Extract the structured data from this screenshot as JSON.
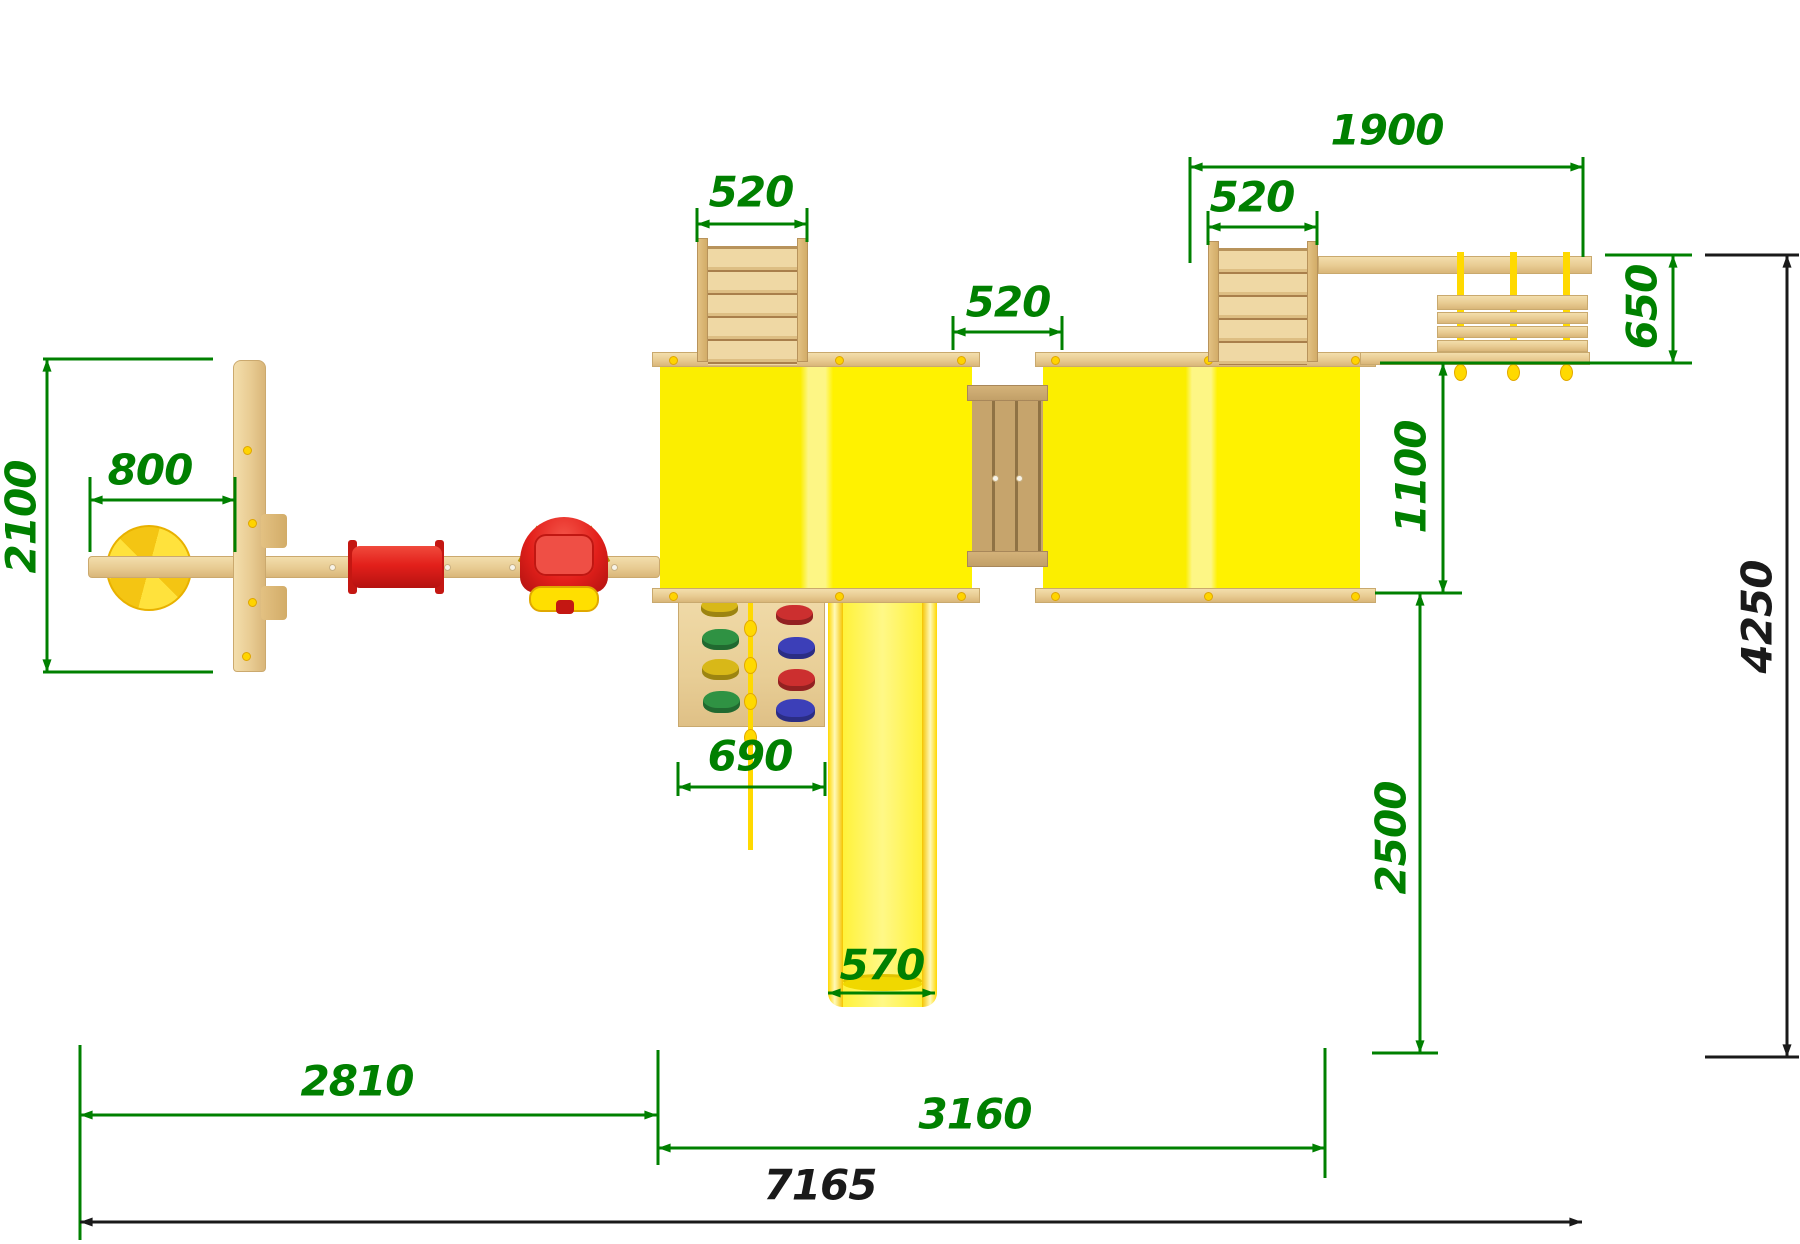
{
  "dims": {
    "d1900": "1900",
    "d520_left": "520",
    "d520_mid": "520",
    "d520_right": "520",
    "d650": "650",
    "d1100": "1100",
    "d800": "800",
    "d2100": "2100",
    "d690": "690",
    "d570": "570",
    "d2500": "2500",
    "d2810": "2810",
    "d3160": "3160",
    "d7165": "7165",
    "d4250": "4250"
  },
  "colors": {
    "dimension_green": "#008000",
    "overall_dimension_black": "#1a1a1a",
    "roof_yellow": "#FBEE00",
    "roof_ridge_highlight": "#FDF685",
    "slide_yellow": "#FFF435",
    "wood_light": "#EBD29C",
    "wood_dark": "#C6A46C",
    "swing_red": "#E3201B",
    "rope_yellow": "#FFD900"
  }
}
